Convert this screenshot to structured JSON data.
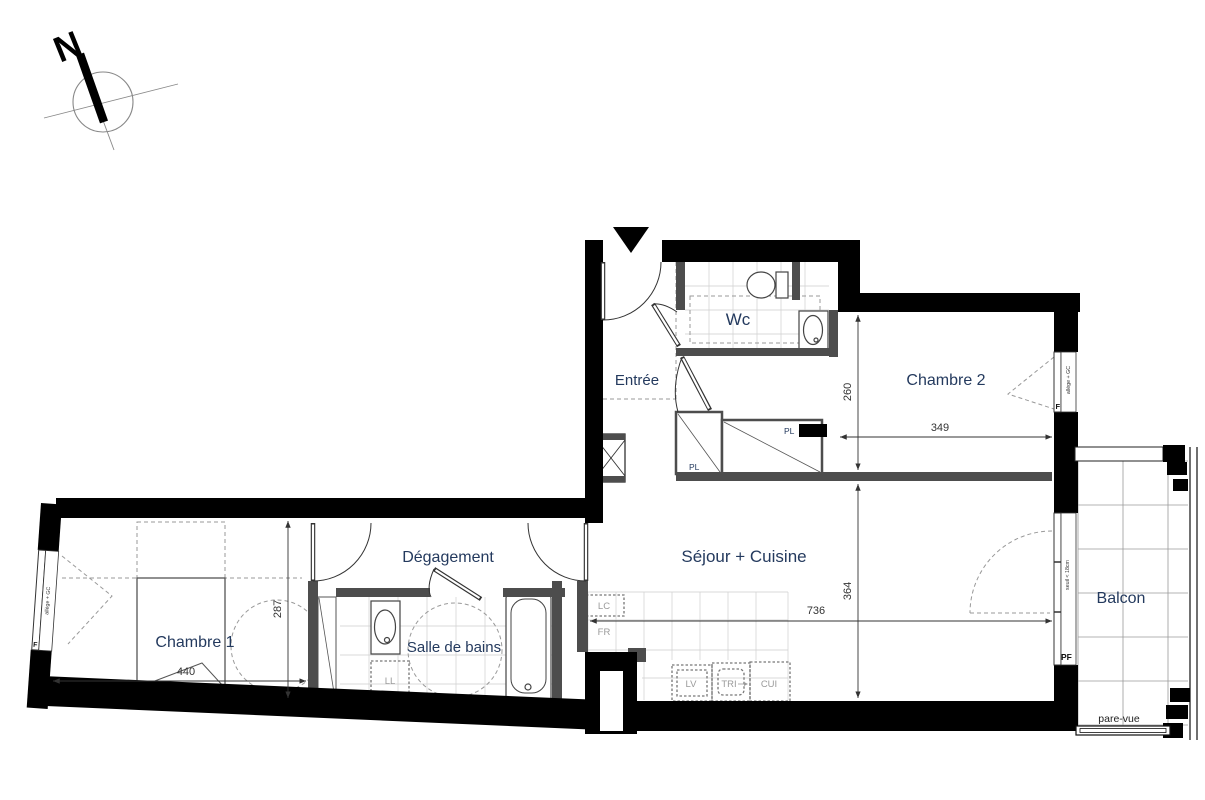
{
  "compass": {
    "north_label": "N"
  },
  "rooms": {
    "entree": {
      "label": "Entrée"
    },
    "wc": {
      "label": "Wc"
    },
    "chambre2": {
      "label": "Chambre 2",
      "dim_width": "349",
      "dim_height": "260"
    },
    "sejour_cuisine": {
      "label": "Séjour + Cuisine",
      "dim_width": "736",
      "dim_height": "364"
    },
    "degagement": {
      "label": "Dégagement"
    },
    "salle_de_bains": {
      "label": "Salle de bains"
    },
    "chambre1": {
      "label": "Chambre 1",
      "dim_width": "440",
      "dim_height": "287"
    },
    "balcon": {
      "label": "Balcon",
      "screen": "pare-vue"
    }
  },
  "labels": {
    "closet": "PL",
    "washing_column": "LC",
    "fridge": "FR",
    "dishwasher": "LV",
    "sorting": "TRI",
    "cooktop": "CUI",
    "washer": "LL"
  },
  "windows": {
    "window_tag": "F",
    "french_window_tag": "PF",
    "sill_note": "allège + GC",
    "threshold_note": "seuil < 18cm"
  },
  "colors": {
    "wall": "#000000",
    "partition": "#4d4d4d",
    "room_label": "#243a5e",
    "dimension": "#333333",
    "fixture_label": "#9a9a9a",
    "tile_line": "#cecece"
  }
}
